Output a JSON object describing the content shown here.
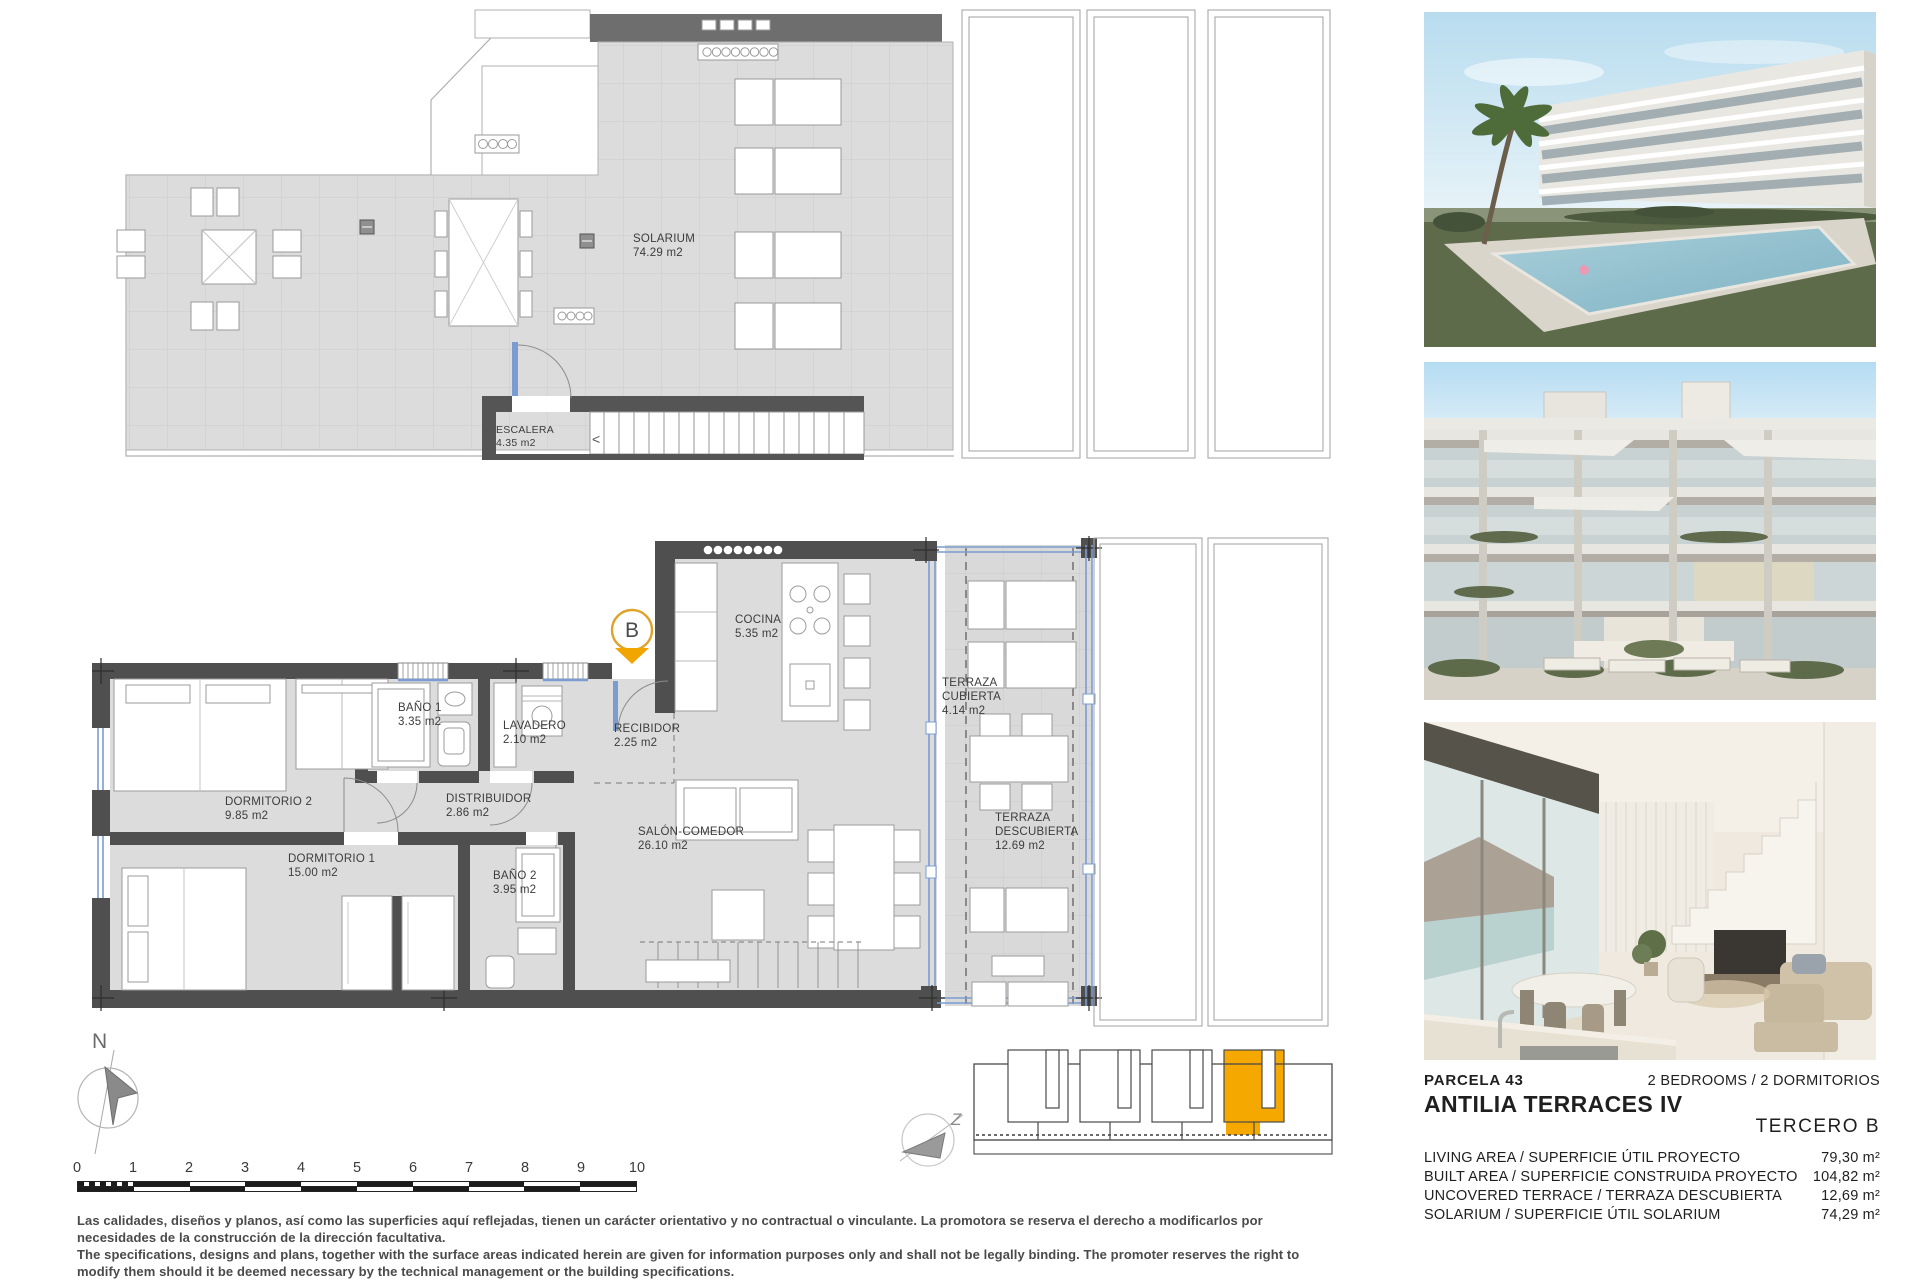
{
  "top_plan": {
    "rooms": [
      {
        "name": "SOLARIUM",
        "area": "74.29 m2"
      },
      {
        "name": "ESCALERA",
        "area": "4.35 m2"
      }
    ]
  },
  "main_plan": {
    "marker": "B",
    "rooms": [
      {
        "name": "DORMITORIO 2",
        "area": "9.85 m2"
      },
      {
        "name": "BAÑO 1",
        "area": "3.35 m2"
      },
      {
        "name": "LAVADERO",
        "area": "2.10 m2"
      },
      {
        "name": "RECIBIDOR",
        "area": "2.25 m2"
      },
      {
        "name": "COCINA",
        "area": "5.35 m2"
      },
      {
        "name": "DISTRIBUIDOR",
        "area": "2.86 m2"
      },
      {
        "name": "DORMITORIO 1",
        "area": "15.00 m2"
      },
      {
        "name": "BAÑO 2",
        "area": "3.95 m2"
      },
      {
        "name": "SALÓN-COMEDOR",
        "area": "26.10 m2"
      },
      {
        "name": "TERRAZA CUBIERTA",
        "area": "4.14 m2"
      },
      {
        "name": "TERRAZA DESCUBIERTA",
        "area": "12.69 m2"
      }
    ]
  },
  "scale_bar": {
    "labels": [
      "0",
      "1",
      "2",
      "3",
      "4",
      "5",
      "6",
      "7",
      "8",
      "9",
      "10"
    ]
  },
  "north_label": "N",
  "keyplan_compass_label": "Z",
  "info": {
    "parcela": "PARCELA 43",
    "bedrooms": "2 BEDROOMS / 2 DORMITORIOS",
    "project": "ANTILIA TERRACES IV",
    "floor": "TERCERO B",
    "rows": [
      {
        "label": "LIVING AREA / SUPERFICIE ÚTIL PROYECTO",
        "value": "79,30 m²"
      },
      {
        "label": "BUILT AREA / SUPERFICIE CONSTRUIDA PROYECTO",
        "value": "104,82 m²"
      },
      {
        "label": "UNCOVERED TERRACE / TERRAZA DESCUBIERTA",
        "value": "12,69 m²"
      },
      {
        "label": "SOLARIUM / SUPERFICIE ÚTIL SOLARIUM",
        "value": "74,29 m²"
      }
    ]
  },
  "disclaimer": {
    "es": "Las calidades, diseños y planos, así como las superficies aquí reflejadas, tienen un carácter orientativo y no contractual o vinculante. La promotora se reserva el derecho a modificarlos por necesidades de la construcción de la dirección facultativa.",
    "en": "The specifications, designs and plans, together with the surface areas indicated herein are given for information purposes only and shall not be legally binding. The promoter reserves the right to modify them should it be deemed necessary by the technical management or the building specifications."
  },
  "colors": {
    "accent_orange": "#F2A900",
    "glazing_blue": "#7b9cd0",
    "wall_dark": "#4f4f4f"
  }
}
